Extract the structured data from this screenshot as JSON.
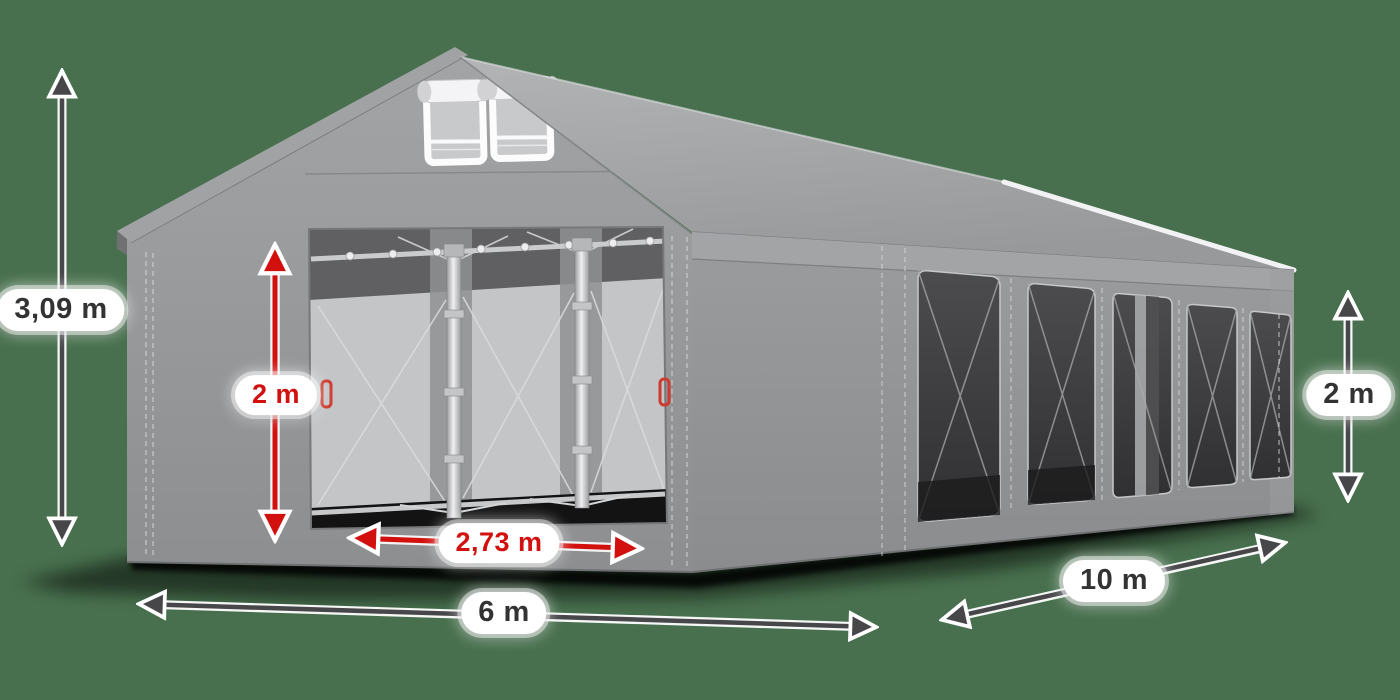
{
  "scene": {
    "type": "product-dimension-diagram",
    "subject": "Gray PVC party tent (marquee), 3D render viewed from front-left, front door open showing inner steel frame, right side wall with five mesh windows, two roll-up vents in the gable",
    "background_color": "#48704E"
  },
  "colors": {
    "dimension_arrow_dark": "#47474A",
    "dimension_arrow_red": "#D2100E",
    "label_pill_background": "#FFFFFF",
    "label_text_dark": "#333333",
    "label_text_red": "#D2100E",
    "tent_fabric_gray": "#919396",
    "window_mesh_dark": "#3E3E40",
    "frame_silver": "#D6D6D8"
  },
  "dimensions": {
    "total_height": {
      "value": "3,09 m",
      "style": "dark",
      "orientation": "vertical",
      "position": "far-left"
    },
    "door_height": {
      "value": "2 m",
      "style": "red",
      "orientation": "vertical",
      "position": "front-door"
    },
    "door_width": {
      "value": "2,73 m",
      "style": "red",
      "orientation": "horizontal",
      "position": "front-door-base"
    },
    "front_width": {
      "value": "6 m",
      "style": "dark",
      "orientation": "horizontal",
      "position": "front-bottom"
    },
    "side_length": {
      "value": "10 m",
      "style": "dark",
      "orientation": "horizontal",
      "position": "right-bottom"
    },
    "side_wall_height": {
      "value": "2 m",
      "style": "dark",
      "orientation": "vertical",
      "position": "right-side"
    }
  }
}
